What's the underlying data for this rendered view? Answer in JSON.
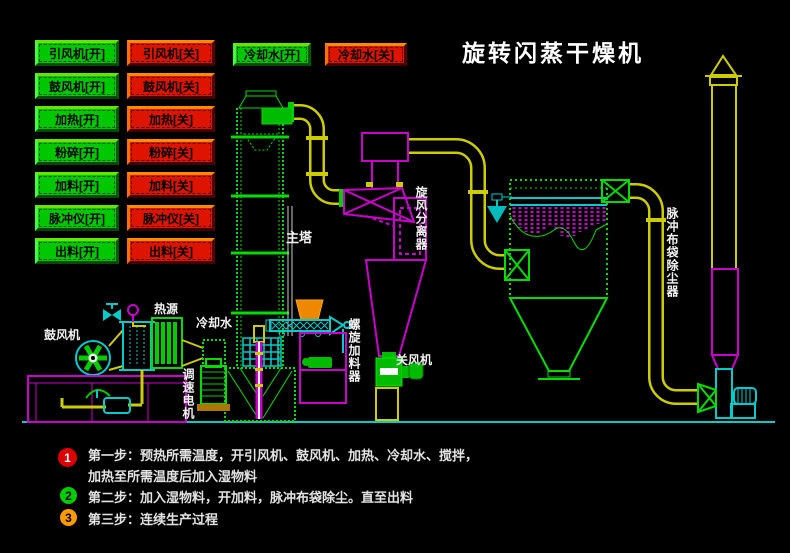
{
  "title": "旋转闪蒸干燥机",
  "buttons": {
    "on": [
      "引风机[开]",
      "鼓风机[开]",
      "加热[开]",
      "粉碎[开]",
      "加料[开]",
      "脉冲仪[开]",
      "出料[开]"
    ],
    "off": [
      "引风机[关]",
      "鼓风机[关]",
      "加热[关]",
      "粉碎[关]",
      "加料[关]",
      "脉冲仪[关]",
      "出料[关]"
    ],
    "cooling_on": "冷却水[开]",
    "cooling_off": "冷却水[关]"
  },
  "equipment_labels": {
    "blower": "鼓风机",
    "heat_source": "热源",
    "cooling_water": "冷却水",
    "speed_motor": "调速电机",
    "main_tower": "主塔",
    "screw_feeder": "螺旋加料器",
    "airlock": "关风机",
    "cyclone": "旋风分离器",
    "bag_filter": "脉冲布袋除尘器"
  },
  "steps": [
    {
      "num": "1",
      "badge_color": "#dd0000",
      "num_color": "#ffffff",
      "lines": [
        "第一步：预热所需温度，开引风机、鼓风机、加热、冷却水、搅拌，",
        "加热至所需温度后加入湿物料"
      ]
    },
    {
      "num": "2",
      "badge_color": "#00cc00",
      "num_color": "#000000",
      "lines": [
        "第二步：加入湿物料，开加料，脉冲布袋除尘。直至出料"
      ]
    },
    {
      "num": "3",
      "badge_color": "#ff9900",
      "num_color": "#000000",
      "lines": [
        "第三步：连续生产过程"
      ]
    }
  ],
  "colors": {
    "on_button": "#00c800",
    "off_button": "#dc1400",
    "pipe_yellow": "#cccc00",
    "equipment_green": "#00dd00",
    "cyclone_magenta": "#cc00cc",
    "cyan": "#00cccc",
    "hopper_orange": "#ee8800",
    "title_white": "#ffffff"
  }
}
